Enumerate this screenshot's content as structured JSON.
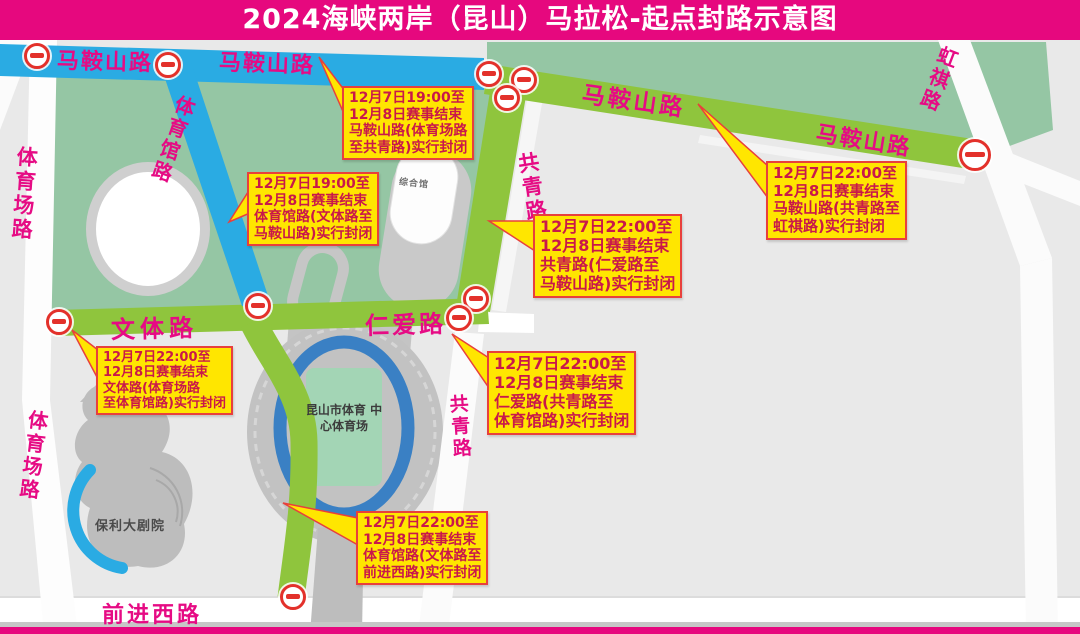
{
  "header": {
    "title": "2024海峡两岸（昆山）马拉松-起点封路示意图"
  },
  "roads": {
    "mashan": "马鞍山路",
    "tiyuchang": "体育场路",
    "tiyuguan": "体育馆路",
    "gongqing": "共青路",
    "wenti": "文体路",
    "renai": "仁爱路",
    "hongqi": "虹祺路",
    "qianjin": "前进西路"
  },
  "buildings": {
    "stadium_line1": "昆山市体育",
    "stadium_line2": "中心体育场",
    "gym": "综合馆",
    "theater": "保利大剧院"
  },
  "icons": {
    "no_entry": "no-entry-icon"
  },
  "callouts": [
    {
      "id": "mashan-west",
      "lines": [
        "12月7日19:00至",
        "12月8日赛事结束",
        "马鞍山路(体育场路",
        "至共青路)实行封闭"
      ]
    },
    {
      "id": "tiyuguan-north",
      "lines": [
        "12月7日19:00至",
        "12月8日赛事结束",
        "体育馆路(文体路至",
        "马鞍山路)实行封闭"
      ]
    },
    {
      "id": "gongqing",
      "lines": [
        "12月7日22:00至",
        "12月8日赛事结束",
        "共青路(仁爱路至",
        "马鞍山路)实行封闭"
      ]
    },
    {
      "id": "mashan-east",
      "lines": [
        "12月7日22:00至",
        "12月8日赛事结束",
        "马鞍山路(共青路至",
        "虹祺路)实行封闭"
      ]
    },
    {
      "id": "wenti",
      "lines": [
        "12月7日22:00至",
        "12月8日赛事结束",
        "文体路(体育场路",
        "至体育馆路)实行封闭"
      ]
    },
    {
      "id": "renai",
      "lines": [
        "12月7日22:00至",
        "12月8日赛事结束",
        "仁爱路(共青路至",
        "体育馆路)实行封闭"
      ]
    },
    {
      "id": "tiyuguan-south",
      "lines": [
        "12月7日22:00至",
        "12月8日赛事结束",
        "体育馆路(文体路至",
        "前进西路)实行封闭"
      ]
    }
  ],
  "colors": {
    "banner": "#e6087e",
    "road_closed_1900": "#2aabe3",
    "road_closed_2200": "#8fc53d",
    "park": "#95c6a4",
    "callout_bg": "#ffe600",
    "callout_border": "#e8403c",
    "callout_text": "#c9184a",
    "road_label": "#e60b84",
    "no_entry_red": "#e3312b"
  }
}
